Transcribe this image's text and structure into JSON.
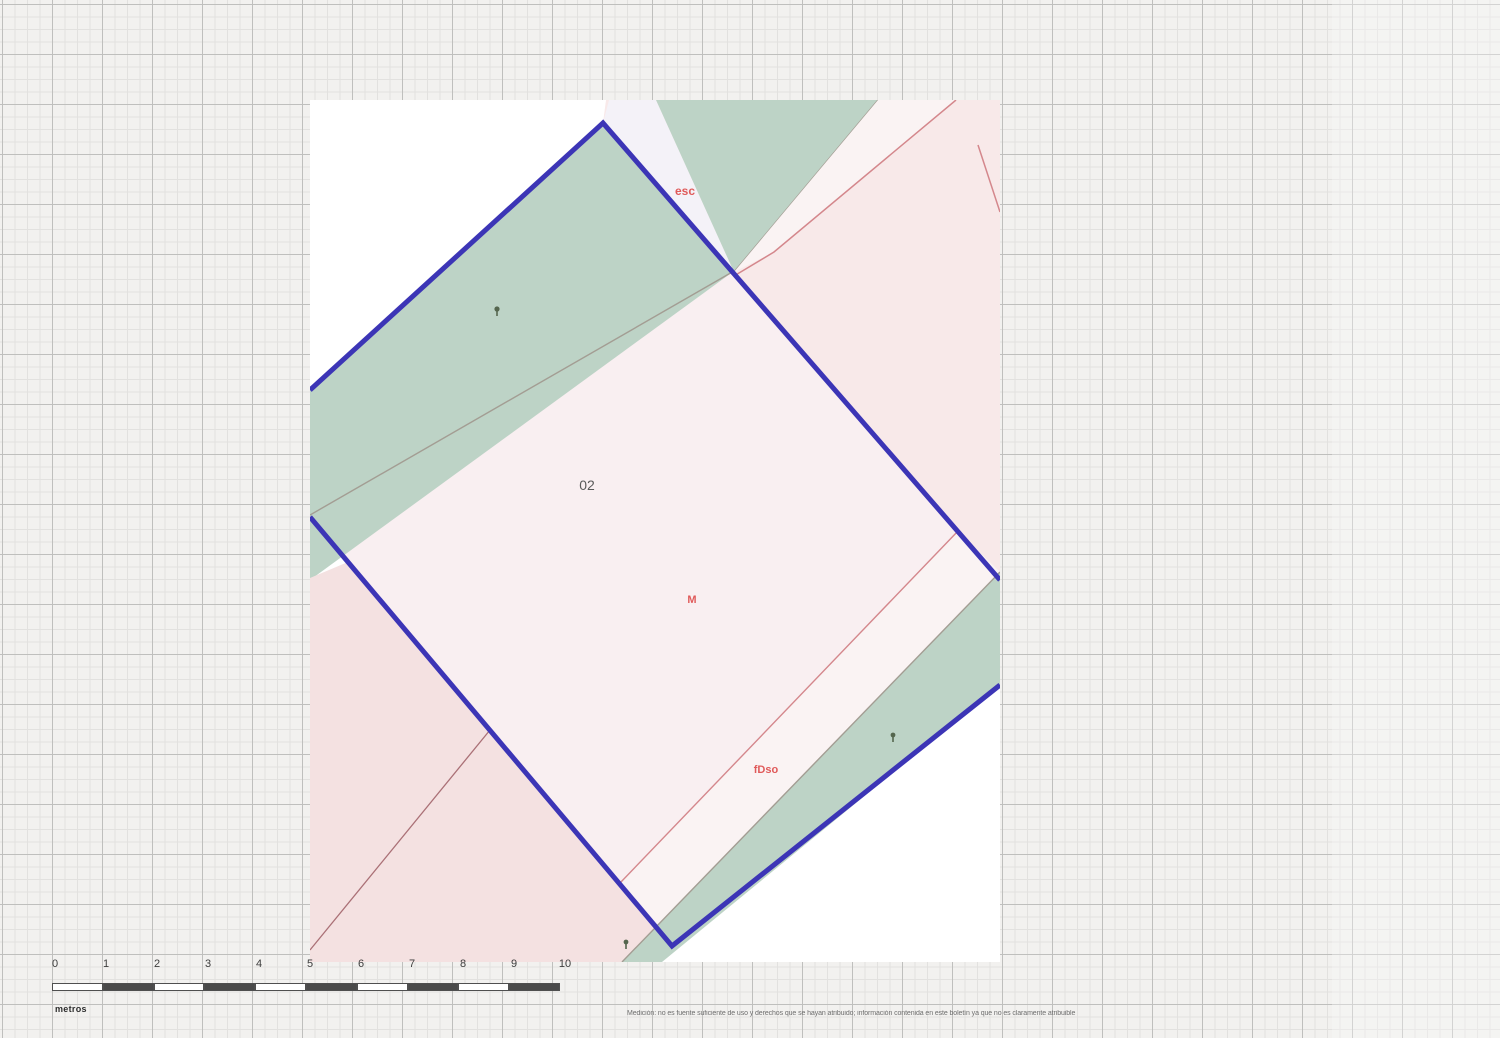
{
  "map_sheet": {
    "labels": {
      "road_label": "esc",
      "parcel_number": "02",
      "subparcel_label": "M",
      "plot_label": "fDso"
    }
  },
  "scale_bar": {
    "tick_labels": [
      "0",
      "1",
      "2",
      "3",
      "4",
      "5",
      "6",
      "7",
      "8",
      "9",
      "10"
    ],
    "unit_label": "metros"
  },
  "footer": {
    "disclaimer_text": "Medición: no es fuente suficiente de uso y derechos que se hayan atribuido; información contenida en este boletín ya que no es claramente atribuible"
  },
  "colors": {
    "parcel_outline_blue": "#3c35b6",
    "boundary_red": "#d4878c",
    "boundary_maroon": "#aa7076",
    "boundary_gray": "#a39d93",
    "vegetation_green": "#bdd3c6",
    "parcel_pink_light": "#f9eff1",
    "parcel_pink": "#f8e9e9",
    "parcel_pale_strip": "#f4f2f8",
    "parcel_pale_strip2": "#faf3f3",
    "parcel_salmon": "#f4e1e1",
    "label_red": "#e05a5a",
    "label_dark": "#5a5a5a",
    "tree_marker_green": "#55664e",
    "scalebar_dark": "#4a4a4a"
  }
}
